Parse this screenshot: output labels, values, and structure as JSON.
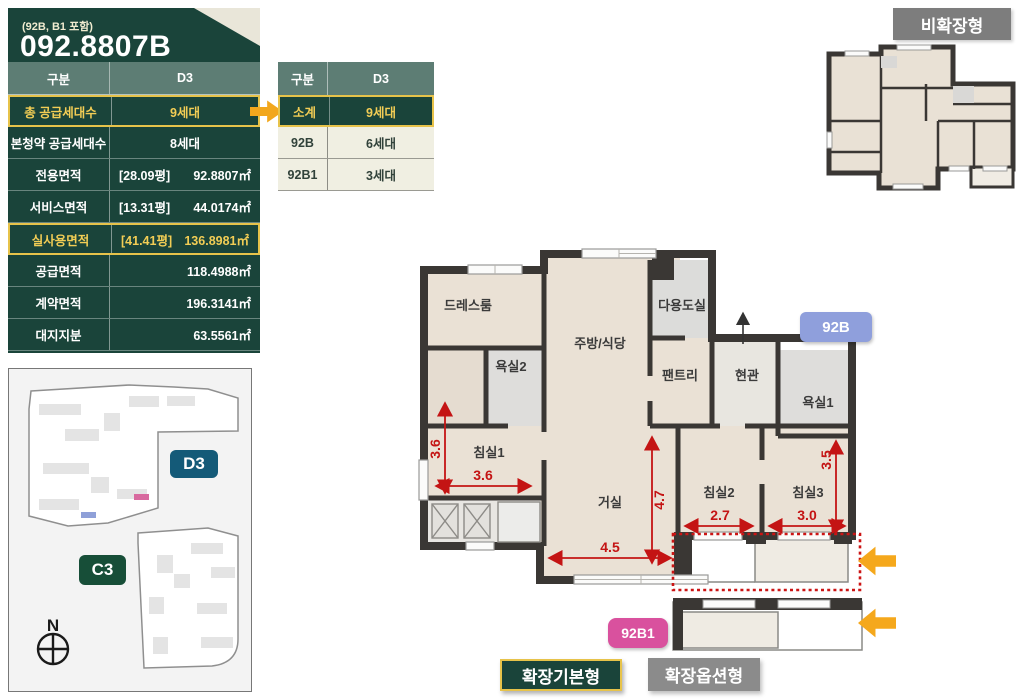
{
  "unit_card": {
    "subtitle": "(92B, B1 포함)",
    "title": "092.8807B",
    "table": {
      "col1_header": "구분",
      "col2_header": "D3",
      "rows": [
        {
          "label": "총 공급세대수",
          "value": "9세대"
        },
        {
          "label": "본청약 공급세대수",
          "value": "8세대"
        },
        {
          "label": "전용면적",
          "pyeong": "[28.09평]",
          "value": "92.8807㎡"
        },
        {
          "label": "서비스면적",
          "pyeong": "[13.31평]",
          "value": "44.0174㎡"
        },
        {
          "label": "실사용면적",
          "pyeong": "[41.41평]",
          "value": "136.8981㎡"
        },
        {
          "label": "공급면적",
          "value": "118.4988㎡"
        },
        {
          "label": "계약면적",
          "value": "196.3141㎡"
        },
        {
          "label": "대지지분",
          "value": "63.5561㎡"
        }
      ]
    }
  },
  "breakdown_table": {
    "col1_header": "구분",
    "col2_header": "D3",
    "rows": [
      {
        "label": "소계",
        "value": "9세대"
      },
      {
        "label": "92B",
        "value": "6세대"
      },
      {
        "label": "92B1",
        "value": "3세대"
      }
    ]
  },
  "plan_badges": {
    "non_expanded": "비확장형",
    "unit_92b": "92B",
    "unit_92b1": "92B1",
    "expanded_basic": "확장기본형",
    "expanded_option": "확장옵션형"
  },
  "floor_plan": {
    "rooms": {
      "dress_room": "드레스룸",
      "kitchen_dining": "주방/식당",
      "utility_room": "다용도실",
      "bathroom2": "욕실2",
      "pantry": "팬트리",
      "entrance": "현관",
      "bathroom1": "욕실1",
      "bedroom1": "침실1",
      "living_room": "거실",
      "bedroom2": "침실2",
      "bedroom3": "침실3"
    },
    "dimensions": {
      "bedroom1_width": "3.6",
      "bedroom1_height": "3.6",
      "living_width": "4.5",
      "living_height": "4.7",
      "bedroom2_width": "2.7",
      "bedroom3_width": "3.0",
      "bedroom3_height": "3.5"
    }
  },
  "site_map": {
    "block_d3": "D3",
    "block_c3": "C3",
    "compass": "N"
  },
  "colors": {
    "card_green": "#1a443a",
    "table_header_green": "#5d7d74",
    "highlight_yellow": "#e7c34a",
    "cream_row": "#f0efe2",
    "badge_gray": "#7d7d7d",
    "badge_92b_blue": "#8f9fdc",
    "badge_92b1_pink": "#d9519e",
    "badge_d3_blue": "#145a78",
    "badge_c3_green": "#174e38",
    "option_arrow_orange": "#f5a81c",
    "dimension_red": "#c41414",
    "wall_dark": "#3a3734",
    "floor_beige": "#eae1d5"
  }
}
